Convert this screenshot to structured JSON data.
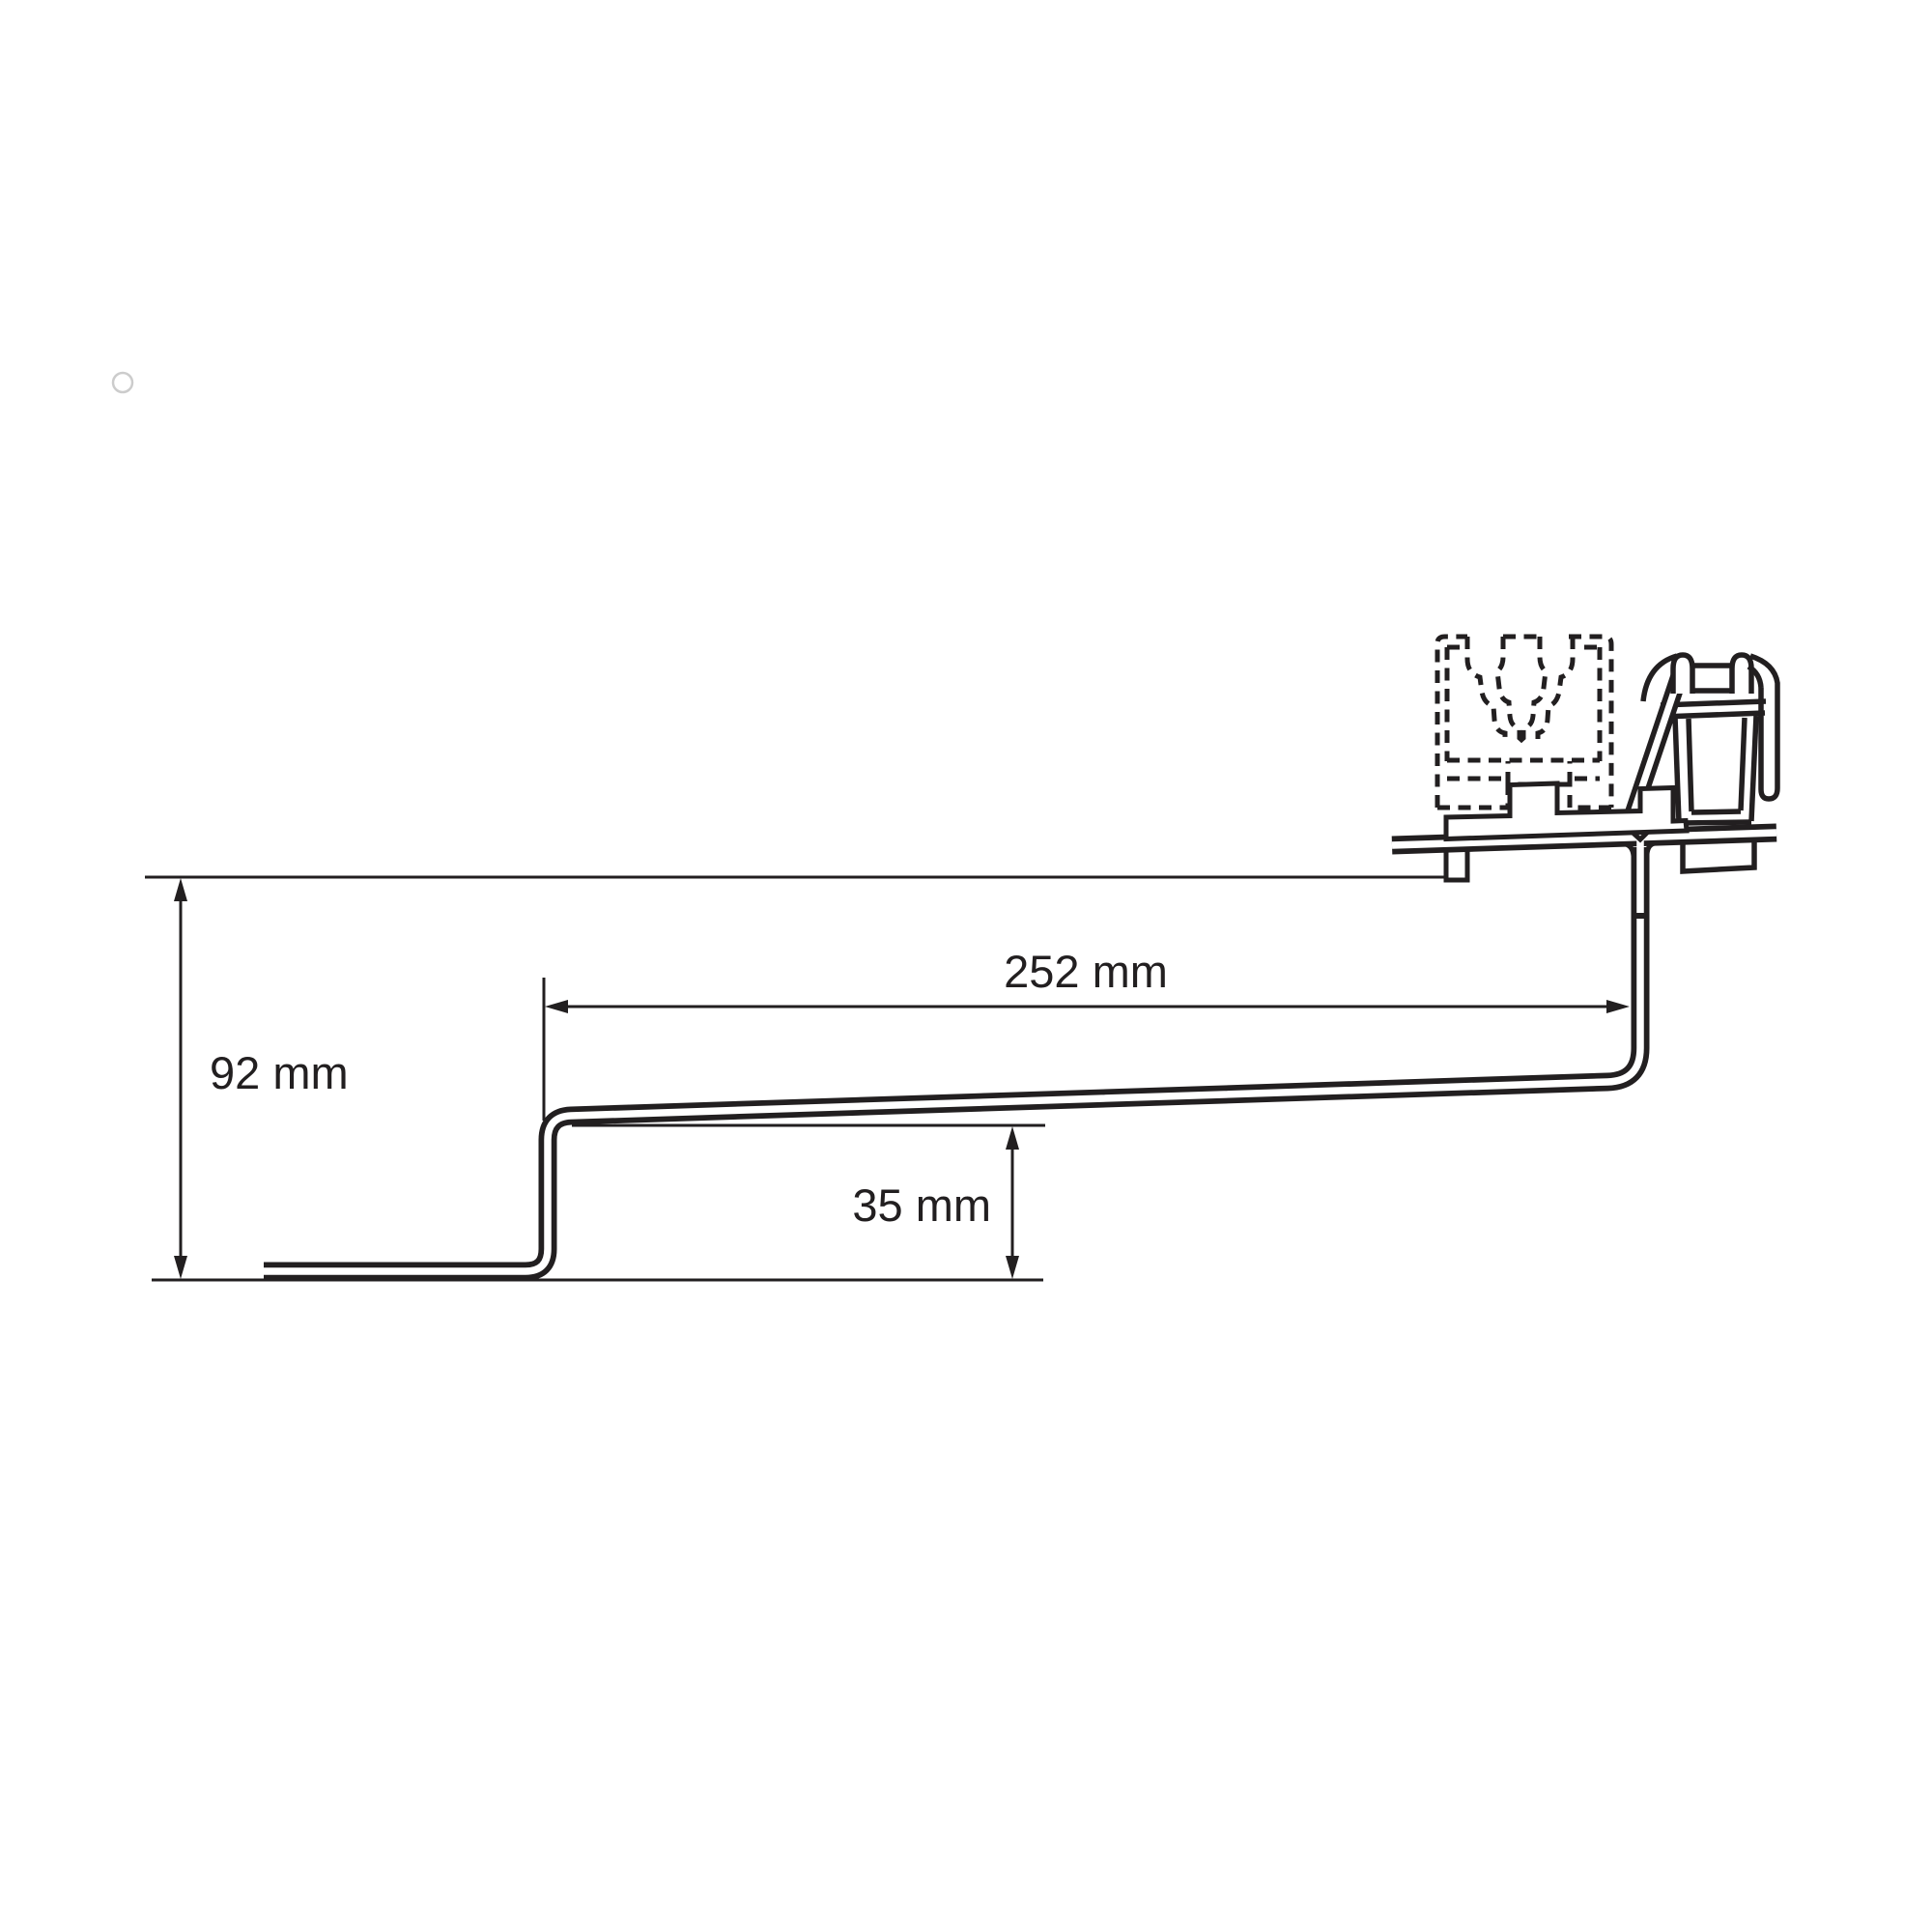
{
  "diagram": {
    "type": "technical-drawing",
    "subject": "roof-hook bracket side profile with rail clamp",
    "labels": {
      "height": "92 mm",
      "length": "252 mm",
      "step": "35 mm"
    },
    "colors": {
      "line": "#221f20",
      "faint_mark": "#cccccc",
      "background": "#ffffff"
    }
  }
}
